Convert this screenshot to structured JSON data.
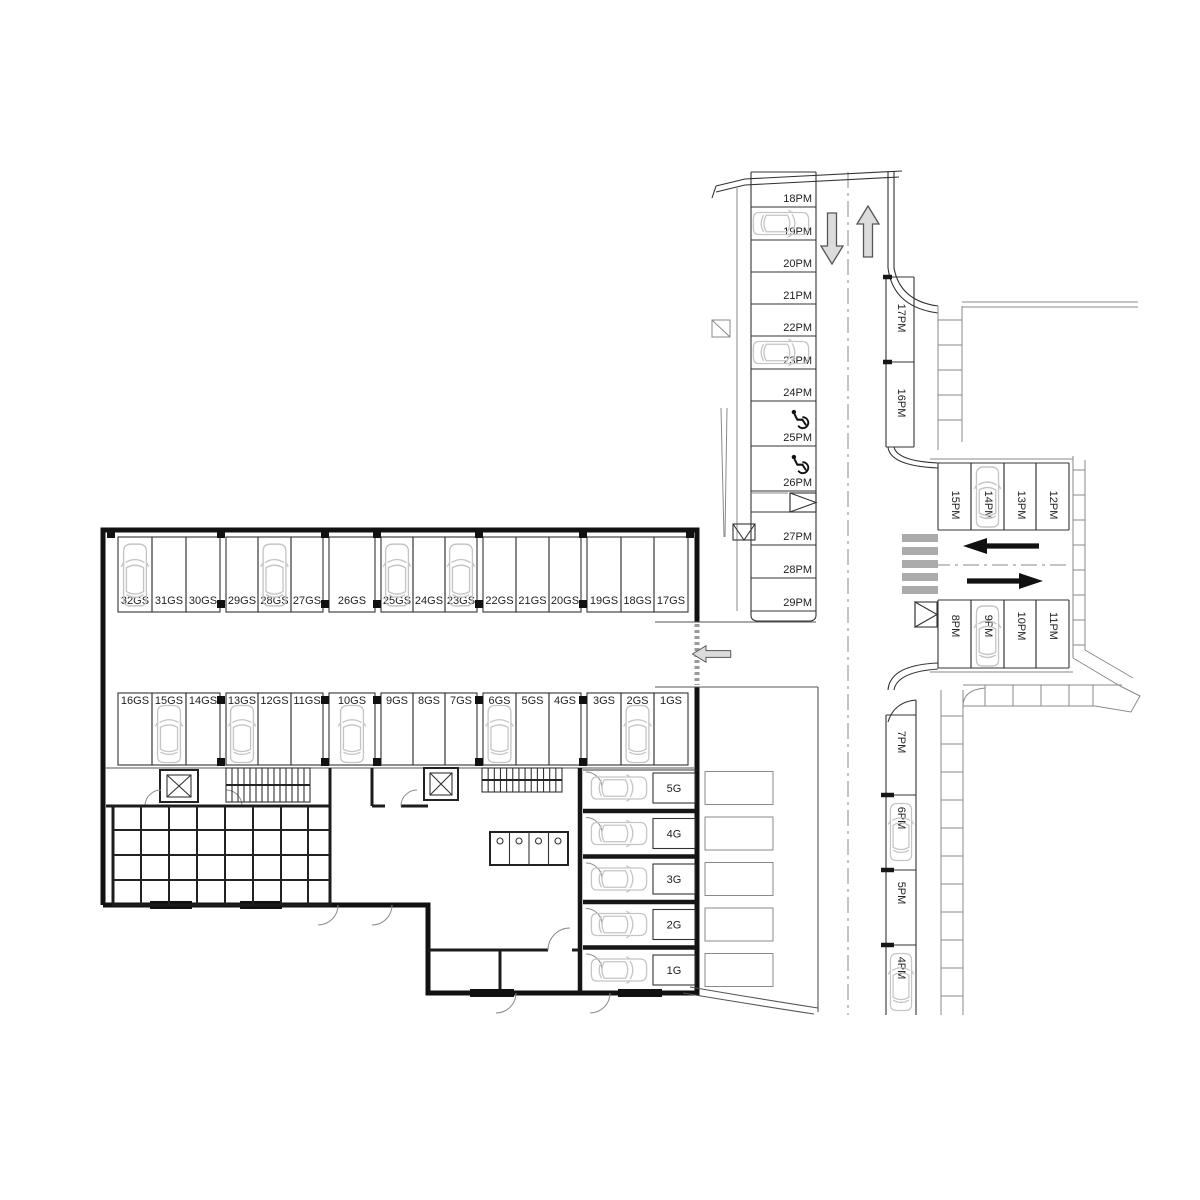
{
  "plan": {
    "title": "Ground floor parking plan",
    "garage_row_upper": [
      {
        "label": "32GS",
        "car": true
      },
      {
        "label": "31GS",
        "car": false
      },
      {
        "label": "30GS",
        "car": false
      },
      {
        "label": "29GS",
        "car": false
      },
      {
        "label": "28GS",
        "car": true
      },
      {
        "label": "27GS",
        "car": false
      },
      {
        "label": "26GS",
        "car": false
      },
      {
        "label": "25GS",
        "car": true
      },
      {
        "label": "24GS",
        "car": false
      },
      {
        "label": "23GS",
        "car": true
      },
      {
        "label": "22GS",
        "car": false
      },
      {
        "label": "21GS",
        "car": false
      },
      {
        "label": "20GS",
        "car": false
      },
      {
        "label": "19GS",
        "car": false
      },
      {
        "label": "18GS",
        "car": false
      },
      {
        "label": "17GS",
        "car": false
      }
    ],
    "garage_row_lower": [
      {
        "label": "16GS",
        "car": false
      },
      {
        "label": "15GS",
        "car": true
      },
      {
        "label": "14GS",
        "car": false
      },
      {
        "label": "13GS",
        "car": true
      },
      {
        "label": "12GS",
        "car": false
      },
      {
        "label": "11GS",
        "car": false
      },
      {
        "label": "10GS",
        "car": true
      },
      {
        "label": "9GS",
        "car": false
      },
      {
        "label": "8GS",
        "car": false
      },
      {
        "label": "7GS",
        "car": false
      },
      {
        "label": "6GS",
        "car": true
      },
      {
        "label": "5GS",
        "car": false
      },
      {
        "label": "4GS",
        "car": false
      },
      {
        "label": "3GS",
        "car": false
      },
      {
        "label": "2GS",
        "car": true
      },
      {
        "label": "1GS",
        "car": false
      }
    ],
    "private_garages": [
      {
        "label": "5G",
        "car": true
      },
      {
        "label": "4G",
        "car": true
      },
      {
        "label": "3G",
        "car": true
      },
      {
        "label": "2G",
        "car": true
      },
      {
        "label": "1G",
        "car": true
      }
    ],
    "street_west_stalls": [
      {
        "label": "18PM",
        "car": false,
        "accessible": false
      },
      {
        "label": "19PM",
        "car": true,
        "accessible": false
      },
      {
        "label": "20PM",
        "car": false,
        "accessible": false
      },
      {
        "label": "21PM",
        "car": false,
        "accessible": false
      },
      {
        "label": "22PM",
        "car": false,
        "accessible": false
      },
      {
        "label": "23PM",
        "car": true,
        "accessible": false
      },
      {
        "label": "24PM",
        "car": false,
        "accessible": false
      },
      {
        "label": "25PM",
        "car": false,
        "accessible": true
      },
      {
        "label": "26PM",
        "car": false,
        "accessible": true
      },
      {
        "label": "27PM",
        "car": false,
        "accessible": false
      },
      {
        "label": "28PM",
        "car": false,
        "accessible": false
      },
      {
        "label": "29PM",
        "car": false,
        "accessible": false
      }
    ],
    "street_east_stalls_north": [
      {
        "label": "17PM",
        "car": false
      },
      {
        "label": "16PM",
        "car": false
      }
    ],
    "street_east_stalls_south": [
      {
        "label": "7PM",
        "car": false
      },
      {
        "label": "6PM",
        "car": true
      },
      {
        "label": "5PM",
        "car": false
      },
      {
        "label": "4PM",
        "car": true
      }
    ],
    "side_street_north_stalls": [
      {
        "label": "15PM",
        "car": false
      },
      {
        "label": "14PM",
        "car": true
      },
      {
        "label": "13PM",
        "car": false
      },
      {
        "label": "12PM",
        "car": false
      }
    ],
    "side_street_south_stalls": [
      {
        "label": "8PM",
        "car": false
      },
      {
        "label": "9PM",
        "car": true
      },
      {
        "label": "10PM",
        "car": false
      },
      {
        "label": "11PM",
        "car": false
      }
    ],
    "traffic": {
      "main_street_lanes": [
        "south",
        "north"
      ],
      "side_street_lanes": [
        "west",
        "east"
      ],
      "building_entrance_direction": "west"
    }
  },
  "colors": {
    "wall": "#111111",
    "stall_line": "#333333",
    "car_outline": "#c5c5c5",
    "gray_arrow_fill": "#dcdcdc",
    "gray_arrow_stroke": "#555555",
    "black_arrow": "#111111",
    "crosswalk": "#ababab",
    "label": "#222222"
  }
}
